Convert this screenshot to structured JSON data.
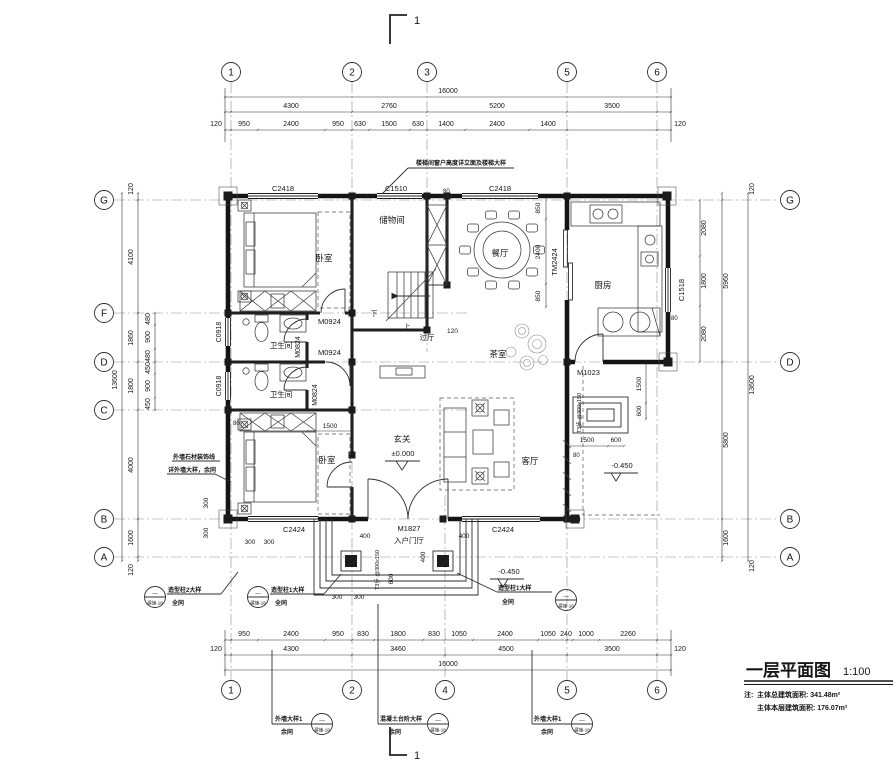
{
  "section_marker": {
    "top": "1",
    "bottom": "1"
  },
  "axis": {
    "top": [
      "1",
      "2",
      "3",
      "5",
      "6"
    ],
    "bottom": [
      "1",
      "2",
      "4",
      "5",
      "6"
    ],
    "left": [
      "G",
      "F",
      "D",
      "C",
      "B",
      "A"
    ],
    "right": [
      "G",
      "D",
      "B",
      "A"
    ]
  },
  "dims": {
    "top": {
      "total": "16000",
      "spans": [
        "4300",
        "2760",
        "5200",
        "3500"
      ],
      "subs": [
        "950",
        "2400",
        "950",
        "630",
        "1500",
        "630",
        "1400",
        "2400",
        "1400"
      ],
      "side": [
        "120",
        "120"
      ]
    },
    "bottom": {
      "total": "16000",
      "spans": [
        "4300",
        "3460",
        "4500",
        "3500"
      ],
      "subs": [
        "950",
        "2400",
        "950",
        "830",
        "1800",
        "830",
        "1050",
        "2400",
        "1050",
        "240",
        "1000",
        "2260"
      ],
      "side": [
        "120",
        "120"
      ]
    },
    "left": {
      "total": "13600",
      "spans": [
        "4100",
        "1860",
        "1800",
        "4000",
        "1600"
      ],
      "subs": [
        "480",
        "900",
        "480",
        "450",
        "900",
        "450"
      ],
      "side": [
        "120",
        "120"
      ]
    },
    "right": {
      "total": "13600",
      "spans": [
        "5960",
        "5800",
        "1600"
      ],
      "subs": [
        "2080",
        "1800",
        "2080"
      ],
      "side": [
        "120",
        "120"
      ]
    },
    "inner": {
      "dining_850_top": "850",
      "dining_2400": "2400",
      "dining_850_bottom": "850",
      "hall_120": "120",
      "bath_door_1500": "1500",
      "terrace_1500_h": "1500",
      "terrace_600_h": "600",
      "terrace_1500_v": "1500",
      "terrace_600_v": "600",
      "top_80": "80",
      "kitchen_80": "80",
      "left_80": "80",
      "living_80": "80",
      "porch_400_left": "400",
      "porch_400_right": "400",
      "porch_400_mid": "400",
      "porch_600": "600",
      "porch_300_a": "300",
      "porch_300_b": "300",
      "corner_300_a": "300",
      "corner_300_b": "300",
      "corner_300_c": "300",
      "corner_300_d": "300"
    }
  },
  "rooms": {
    "bedroom_top": "卧室",
    "bedroom_bottom": "卧室",
    "storage": "储物间",
    "dining": "餐厅",
    "kitchen": "厨房",
    "bath_top": "卫生间",
    "bath_bottom": "卫生间",
    "hall": "过厅",
    "tea": "茶室",
    "entry": "玄关",
    "living": "客厅",
    "foyer": "入户门厅"
  },
  "openings": {
    "c2418_left": "C2418",
    "c1510": "C1510",
    "c2418_right": "C2418",
    "c1518": "C1518",
    "c2424_left": "C2424",
    "c2424_right": "C2424",
    "c0918_top": "C0918",
    "c0918_bottom": "C0918",
    "m0924_top": "M0924",
    "m0924_bottom": "M0924",
    "m0824_top": "M0824",
    "m0824_bottom": "M0824",
    "m1827": "M1827",
    "m1023": "M1023",
    "tm2424": "TM2424"
  },
  "levels": {
    "entry": "±0.000",
    "porch": "-0.450",
    "terrace": "-0.450"
  },
  "stairs": {
    "up": "上",
    "down": "下",
    "steps_terrace": "T3步 @300x150",
    "steps_porch": "T3步 @300x150"
  },
  "annotations": {
    "stair_window": "楼梯间窗户高度详立面及楼梯大样",
    "wall_note_1": "外墙石材装饰线",
    "wall_note_2": "详外墙大样，余同",
    "callouts": {
      "col2": {
        "label": "造型柱2大样",
        "sub": "全同"
      },
      "col1_left": {
        "label": "造型柱1大样",
        "sub": "全同"
      },
      "col1_right": {
        "label": "造型柱1大样",
        "sub": "全同"
      },
      "wall_left": {
        "label": "外墙大样1",
        "sub": "余同"
      },
      "concrete": {
        "label": "混凝土台阶大样",
        "sub": "余同"
      },
      "wall_right": {
        "label": "外墙大样1",
        "sub": "余同"
      },
      "bubble_top": "—",
      "bubble_bottom": "建施-18"
    }
  },
  "title_block": {
    "title": "一层平面图",
    "scale": "1:100",
    "note_label": "注:",
    "note_1": "主体总建筑面积: 341.48m²",
    "note_2": "主体本层建筑面积: 176.07m²"
  }
}
